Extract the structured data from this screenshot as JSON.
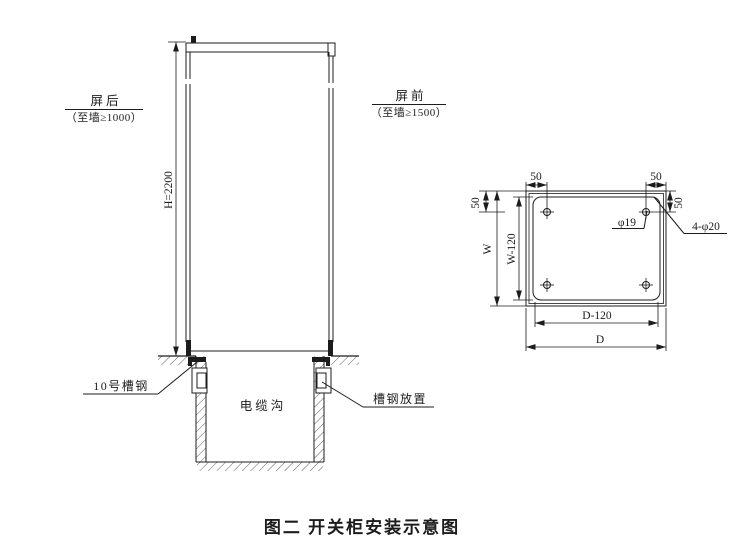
{
  "figure": {
    "caption": "图二  开关柜安装示意图"
  },
  "side_view": {
    "rear_label": "屏后",
    "rear_clearance": "（至墙≥1000）",
    "front_label": "屏前",
    "front_clearance": "（至墙≥1500）",
    "height_dim": "H=2200",
    "channel_steel_label": "10号槽钢",
    "cable_trench_label": "电缆沟",
    "channel_placement_label": "槽钢放置"
  },
  "plan_view": {
    "dim_top_left": "50",
    "dim_top_right": "50",
    "dim_side_left": "50",
    "dim_side_right": "50",
    "dim_width": "W",
    "dim_width_inner": "W-120",
    "dim_depth_inner": "D-120",
    "dim_depth": "D",
    "hole_diameter": "φ19",
    "corner_holes": "4-φ20"
  },
  "colors": {
    "line": "#1c1c1c",
    "background": "#ffffff"
  }
}
